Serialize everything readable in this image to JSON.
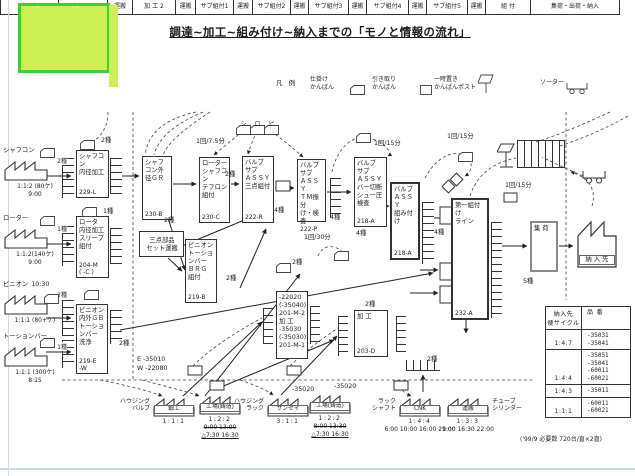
{
  "page": {
    "title": "調達~加工~組み付け~納入までの「モノと情報の流れ」",
    "footer_note": "('99/9  必要数 720台/直×2直)"
  },
  "legend": {
    "heading": "凡 例",
    "items": [
      {
        "icon": "kanban-card-icon",
        "label": "仕掛け\nかんばん"
      },
      {
        "icon": "kanban-card-icon",
        "label": "引き取り\nかんばん"
      },
      {
        "icon": "kanban-post-icon",
        "label": "一時置き\nかんばんポスト"
      },
      {
        "icon": "sorter-cart-icon",
        "label": "ソーター"
      }
    ]
  },
  "band": {
    "segments": [
      {
        "label": "調 達",
        "w": 58
      },
      {
        "label": "加 工 1",
        "w": 49
      },
      {
        "label": "運搬",
        "w": 25
      },
      {
        "label": "加 工 2",
        "w": 43
      },
      {
        "label": "運搬",
        "w": 20
      },
      {
        "label": "サブ組付1",
        "w": 38
      },
      {
        "label": "運搬",
        "w": 19
      },
      {
        "label": "サブ組付2",
        "w": 38
      },
      {
        "label": "運搬",
        "w": 18
      },
      {
        "label": "サブ組付3",
        "w": 40
      },
      {
        "label": "運搬",
        "w": 18
      },
      {
        "label": "サブ組付4",
        "w": 42
      },
      {
        "label": "運搬",
        "w": 18
      },
      {
        "label": "サブ組付5",
        "w": 41
      },
      {
        "label": "運搬",
        "w": 18
      },
      {
        "label": "組 付",
        "w": 45
      },
      {
        "label": "集荷・出荷・納入",
        "w": 90
      }
    ]
  },
  "left_factories": [
    {
      "x": 3,
      "y": 146,
      "name": "シャフコン",
      "kinds": "2種",
      "l1": "1:1:2 (80ケ)",
      "l2": "9:00"
    },
    {
      "x": 3,
      "y": 214,
      "name": "ローター",
      "kinds": "1種",
      "l1": "1:1:2(140ケ)",
      "l2": "9:00"
    },
    {
      "x": 3,
      "y": 280,
      "name": "ピニオン",
      "pre": "10:30",
      "kinds": "2種",
      "l1": "1:1:1 (80+ケ)",
      "l2": ""
    },
    {
      "x": 3,
      "y": 332,
      "name": "トーションバー",
      "kinds": "1種",
      "l1": "1:1:1 (300ケ)",
      "l2": "8:15"
    }
  ],
  "boxes": [
    {
      "x": 76,
      "y": 150,
      "w": 33,
      "h": 48,
      "text": "シャフコ\nン\n内径加工",
      "code": "229-L"
    },
    {
      "x": 76,
      "y": 216,
      "w": 33,
      "h": 62,
      "text": "ロータ\n内径加工\nスリーブ\n組付",
      "code": "204-M\n( -C )"
    },
    {
      "x": 76,
      "y": 304,
      "w": 32,
      "h": 70,
      "text": "ピニオン\n内外ＧＢ\nトーショ\nンバー\n洗浄",
      "code": "219-E\n-W"
    },
    {
      "x": 142,
      "y": 156,
      "w": 30,
      "h": 64,
      "text": "シャフ\nコン外\n径ＧＲ",
      "code": "230-B"
    },
    {
      "x": 199,
      "y": 157,
      "w": 31,
      "h": 66,
      "text": "ローター\nシャフコ\nン\nテフロン\n組付",
      "code": "230-C"
    },
    {
      "x": 242,
      "y": 156,
      "w": 32,
      "h": 67,
      "text": "バルブ\nサブ\nＡＳＳＹ\n三点組付",
      "code": "222-R"
    },
    {
      "x": 297,
      "y": 159,
      "w": 29,
      "h": 63,
      "text": "バルブ\nサブ\nＡＳＳＹ\nＴＭ振分\nけ・検査",
      "code": "222-P"
    },
    {
      "x": 185,
      "y": 239,
      "w": 32,
      "h": 64,
      "text": "ピニオン\nトーショ\nンバー\nＢＲＧ\n組付",
      "code": "219-B"
    },
    {
      "x": 139,
      "y": 231,
      "w": 45,
      "h": 26,
      "text": "三点部品\nセット運搬",
      "cls": "center"
    },
    {
      "x": 354,
      "y": 157,
      "w": 33,
      "h": 70,
      "text": "バルブ\nサブ\nＡＳＳＹ\nバー切断\nシュー圧\n検査",
      "code": "218-A"
    },
    {
      "x": 390,
      "y": 182,
      "w": 30,
      "h": 78,
      "text": "バルブ\nＡＳＳＹ\n組み付け",
      "code": "218-A",
      "cls": "bold"
    },
    {
      "x": 276,
      "y": 291,
      "w": 32,
      "h": 68,
      "text": "-22020\n(-35040)\n201-M-2\n加 工\n-35030\n(-35030)\n201-M-1"
    },
    {
      "x": 354,
      "y": 310,
      "w": 34,
      "h": 47,
      "text": "加 工",
      "code": "203-D"
    },
    {
      "x": 451,
      "y": 198,
      "w": 38,
      "h": 122,
      "text": "第一組付け\nライン",
      "code": "232-A",
      "cls": "bold"
    },
    {
      "x": 530,
      "y": 221,
      "w": 28,
      "h": 51,
      "text": "集 荷",
      "cls": "gray"
    }
  ],
  "bottom_factories": [
    {
      "x": 152,
      "y": 393,
      "side_l": "ハウジング\nバルブ",
      "name": "鍛工",
      "cycle": "1:1:1"
    },
    {
      "x": 198,
      "y": 391,
      "name": "工場(鋳造)",
      "cycle": "1:2:2",
      "strike": "9:00 13:00",
      "tri": "△7:30 16:30"
    },
    {
      "x": 266,
      "y": 393,
      "side_l": "ハウジング\nラック",
      "name": "サンセイ",
      "cycle": "3:1:1"
    },
    {
      "x": 308,
      "y": 390,
      "name": "工場(鋳造)",
      "cycle": "1:2:2",
      "strike": "8:00 13:30",
      "tri": "△7:30 16:30"
    },
    {
      "x": 398,
      "y": 393,
      "side_l": "ラック\nシャフト",
      "name": "CNK",
      "cycle": "1:4:4",
      "times": "6:00 10:00 16:00 21:00"
    },
    {
      "x": 446,
      "y": 393,
      "side_r": "チューブ\nシリンダー",
      "name": "運搬",
      "cycle": "1:3:3",
      "times": "9:00 16:30 22:00"
    }
  ],
  "delivery": {
    "label": "納 入 先"
  },
  "table": {
    "col1": "納入先\n便サイクル",
    "col2": "品 番",
    "rows": [
      {
        "cycle": "1:4:7",
        "parts": "-35031\n-35041"
      },
      {
        "cycle": "1:4:4",
        "parts": "-35051\n-35041\n-60011\n-60021"
      },
      {
        "cycle": "1:4:3",
        "parts": "-35011"
      },
      {
        "cycle": "1:1:1",
        "parts": "-60011\n-60021"
      }
    ]
  },
  "annotations": [
    {
      "x": 196,
      "y": 138,
      "t": "1回/7.5分"
    },
    {
      "x": 374,
      "y": 140,
      "t": "1回/15分"
    },
    {
      "x": 447,
      "y": 133,
      "t": "1回/15分"
    },
    {
      "x": 505,
      "y": 182,
      "t": "1回/15分"
    },
    {
      "x": 304,
      "y": 234,
      "t": "1回/30分"
    },
    {
      "x": 356,
      "y": 230,
      "t": "4種"
    },
    {
      "x": 101,
      "y": 137,
      "t": "2種"
    },
    {
      "x": 103,
      "y": 208,
      "t": "1種"
    },
    {
      "x": 119,
      "y": 340,
      "t": "2種"
    },
    {
      "x": 164,
      "y": 217,
      "t": "2種"
    },
    {
      "x": 225,
      "y": 171,
      "t": "2種"
    },
    {
      "x": 274,
      "y": 207,
      "t": "4種"
    },
    {
      "x": 330,
      "y": 214,
      "t": "4種"
    },
    {
      "x": 226,
      "y": 275,
      "t": "2種"
    },
    {
      "x": 292,
      "y": 259,
      "t": "2種"
    },
    {
      "x": 365,
      "y": 301,
      "t": "2種"
    },
    {
      "x": 427,
      "y": 356,
      "t": "2種"
    },
    {
      "x": 434,
      "y": 229,
      "t": "4種"
    },
    {
      "x": 523,
      "y": 278,
      "t": "5種"
    },
    {
      "x": 137,
      "y": 356,
      "t": "E  -35010"
    },
    {
      "x": 137,
      "y": 365,
      "t": "W  -22080"
    },
    {
      "x": 292,
      "y": 386,
      "t": "-35020"
    },
    {
      "x": 334,
      "y": 383,
      "t": "-35020"
    }
  ],
  "kanbans": [
    {
      "x": 40,
      "y": 143
    },
    {
      "x": 80,
      "y": 135
    },
    {
      "x": 40,
      "y": 211
    },
    {
      "x": 82,
      "y": 202
    },
    {
      "x": 44,
      "y": 289
    },
    {
      "x": 84,
      "y": 285
    },
    {
      "x": 40,
      "y": 333
    },
    {
      "x": 236,
      "y": 120,
      "ch": "シ"
    },
    {
      "x": 250,
      "y": 120,
      "ch": "ロ"
    },
    {
      "x": 264,
      "y": 120,
      "ch": "ピ"
    },
    {
      "x": 356,
      "y": 128
    },
    {
      "x": 458,
      "y": 147
    },
    {
      "x": 334,
      "y": 246
    },
    {
      "x": 276,
      "y": 258
    }
  ],
  "racks": [
    {
      "x": 62,
      "y": 158,
      "w": 11,
      "h": 40
    },
    {
      "x": 62,
      "y": 226,
      "w": 11,
      "h": 40
    },
    {
      "x": 62,
      "y": 300,
      "w": 11,
      "h": 36
    },
    {
      "x": 62,
      "y": 340,
      "w": 11,
      "h": 28
    },
    {
      "x": 110,
      "y": 158,
      "w": 11,
      "h": 36
    },
    {
      "x": 110,
      "y": 228,
      "w": 11,
      "h": 36
    },
    {
      "x": 110,
      "y": 310,
      "w": 11,
      "h": 34
    },
    {
      "x": 330,
      "y": 178,
      "w": 10,
      "h": 40
    },
    {
      "x": 422,
      "y": 202,
      "w": 11,
      "h": 62
    },
    {
      "x": 491,
      "y": 222,
      "w": 10,
      "h": 96
    },
    {
      "x": 263,
      "y": 308,
      "w": 9,
      "h": 36
    },
    {
      "x": 310,
      "y": 306,
      "w": 9,
      "h": 38
    },
    {
      "x": 338,
      "y": 316,
      "w": 9,
      "h": 40
    },
    {
      "x": 396,
      "y": 316,
      "w": 9,
      "h": 36
    },
    {
      "x": 406,
      "y": 360,
      "w": 34,
      "h": 10,
      "cls": "h"
    }
  ]
}
